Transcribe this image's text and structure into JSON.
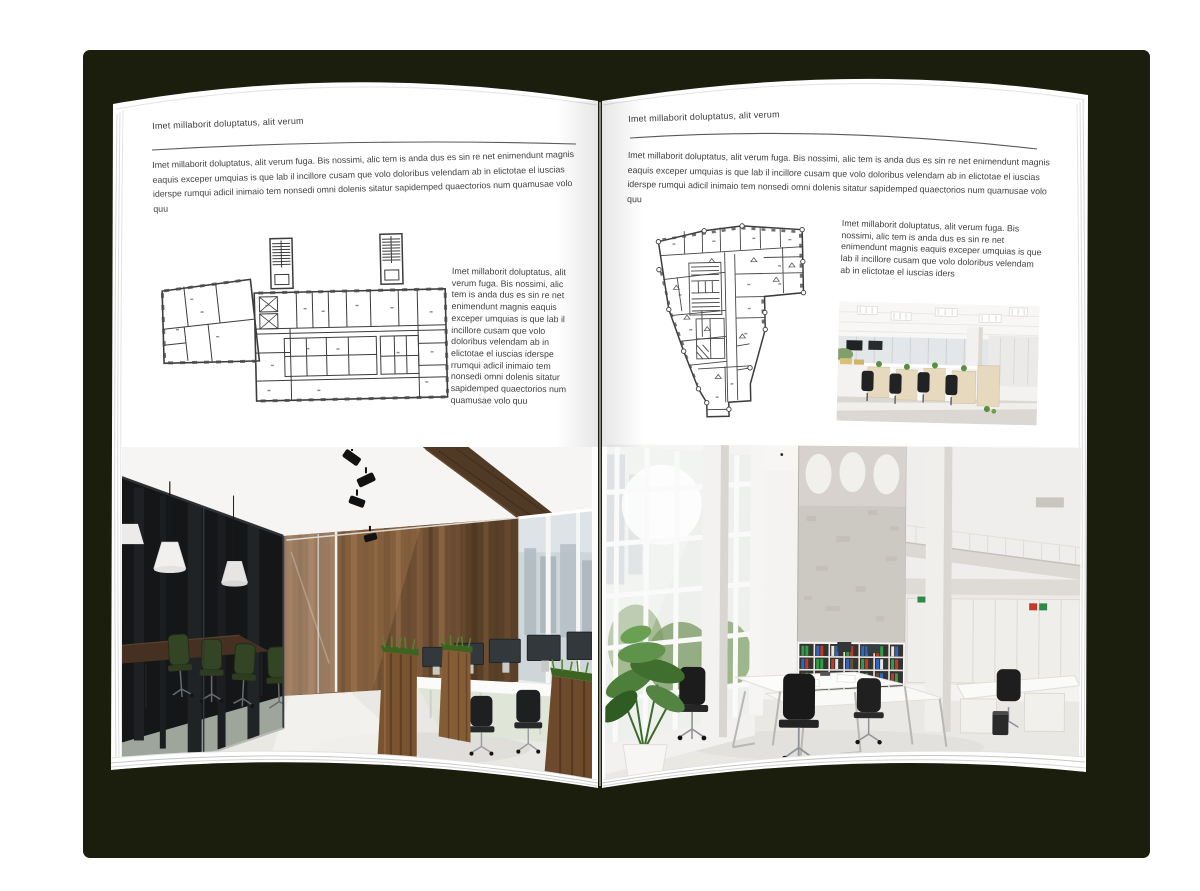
{
  "background": {
    "canvas_color": "#ffffff",
    "cover_color": "#1b1d0d",
    "page_color": "#ffffff"
  },
  "left_page": {
    "header": "Imet millaborit doluptatus, alit verum",
    "intro": "Imet millaborit doluptatus, alit verum fuga. Bis nossimi, alic tem is anda dus es sin re net enimendunt magnis eaquis exceper umquias is que lab il incillore cusam que volo doloribus velendam ab in elictotae el iuscias iderspe rumqui adicil inimaio tem nonsedi omni dolenis sitatur sapidemped quaectorios num quamusae volo quu",
    "side_text": "Imet millaborit doluptatus, alit verum fuga. Bis nossimi, alic tem is anda dus es sin re net enimendunt magnis eaquis exceper umquias is que lab il incillore cusam que volo doloribus velendam ab in elictotae el iuscias iderspe rrumqui adicil inimaio tem nonsedi omni dolenis sitatur sapidemped quaectorios num quamusae volo quu"
  },
  "right_page": {
    "header": "Imet millaborit doluptatus, alit verum",
    "intro": "Imet millaborit doluptatus, alit verum fuga. Bis nossimi, alic tem is anda dus es sin re net enimendunt magnis eaquis exceper umquias is que lab il incillore cusam que volo doloribus velendam ab in elictotae el iuscias iderspe rumqui adicil inimaio tem nonsedi omni dolenis sitatur sapidemped quaectorios num quamusae volo quu",
    "side_text": "Imet millaborit doluptatus, alit verum fuga. Bis nossimi, alic tem is anda dus es sin re net enimendunt magnis eaquis exceper umquias is que lab il incillore cusam que volo doloribus velendam ab in elictotae el iuscias iders"
  }
}
